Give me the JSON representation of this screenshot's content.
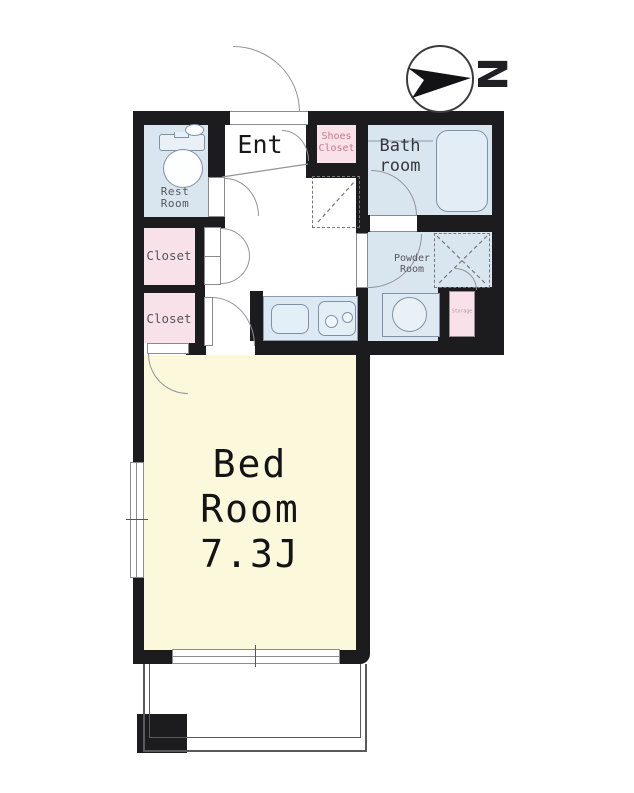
{
  "compass": {
    "north_label": "N"
  },
  "rooms": {
    "ent": {
      "label": "Ent"
    },
    "rest_room": {
      "line1": "Rest",
      "line2": "Room"
    },
    "shoes_closet": {
      "line1": "Shoes",
      "line2": "Closet"
    },
    "bath_room": {
      "line1": "Bath",
      "line2": "room"
    },
    "powder_room": {
      "line1": "Powder",
      "line2": "Room"
    },
    "closet_upper": {
      "label": "Closet"
    },
    "closet_lower": {
      "label": "Closet"
    },
    "storage": {
      "label": "Storage"
    },
    "bed_room": {
      "line1": "Bed",
      "line2": "Room",
      "size_label": "7.3J"
    }
  },
  "colors": {
    "wall": "#1c1c1e",
    "wet": "#d9e6f0",
    "pink": "#f8e1e8",
    "cream": "#fbf8dc",
    "label_gray": "#55555c",
    "shoes_pink": "#c9788c",
    "line_gray": "#93939a",
    "fixture": "#7f91a6",
    "fixture_fill": "#e9f1f7"
  }
}
